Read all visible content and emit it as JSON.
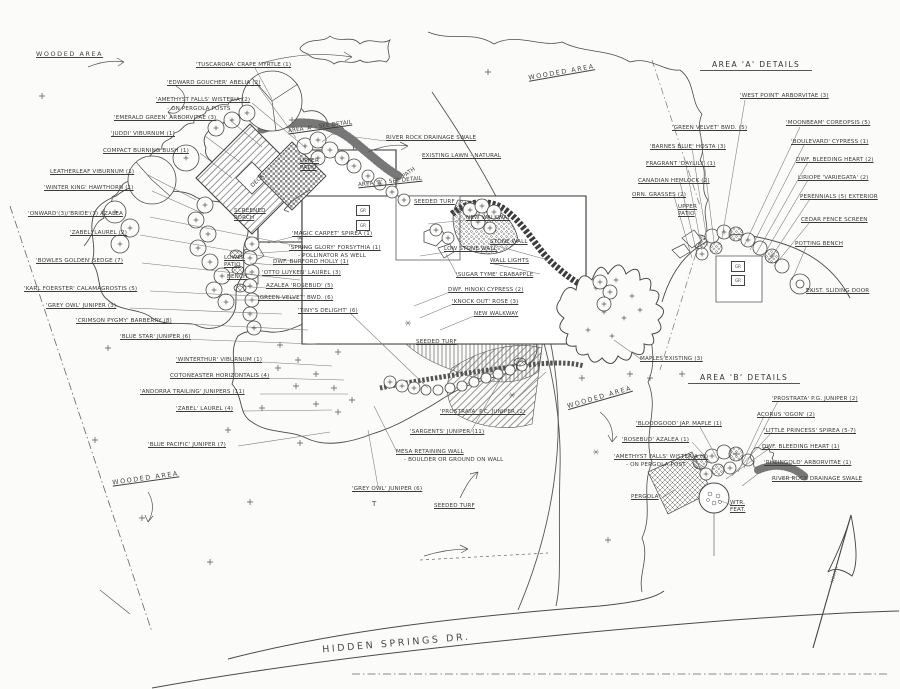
{
  "titles": {
    "area_a": "AREA 'A' DETAILS",
    "area_b": "AREA 'B' DETAILS",
    "road": "HIDDEN SPRINGS DR.",
    "north": "NORTH"
  },
  "misc": {
    "gr": "GR"
  },
  "main": {
    "labels": [
      "WOODED AREA",
      "'TUSCARORA' CRAPE MYRTLE (1)",
      "'EDWARD GOUCHER' ABELIA (2)",
      "'AMETHYST FALLS' WISTERIA (2)",
      "- ON PERGOLA POSTS",
      "'EMERALD GREEN' ARBORVITAE (3)",
      "'JUDDI' VIBURNUM (1)",
      "COMPACT BURNING BUSH (1)",
      "LEATHERLEAF VIBURNUM (1)",
      "'WINTER KING' HAWTHORN (1)",
      "'ONWARD'(3)/'BRIDE'(3) AZALEA",
      "'ZABEL' LAUREL (2)",
      "'BOWLES GOLDEN' SEDGE (7)",
      "'KARL FOERSTER' CALAMAGROSTIS (5)",
      "'GREY OWL' JUNIPER (3)",
      "'CRIMSON PYGMY' BARBERRY (8)",
      "'BLUE STAR' JUNIPER (6)",
      "'WINTERTHUR' VIBURNUM (1)",
      "COTONEASTER HORIZONTALIS (4)",
      "'ANDORRA TRAILING' JUNIPERS (11)",
      "'ZABEL' LAUREL (4)",
      "'BLUE PACIFIC' JUNIPER (7)",
      "WOODED AREA",
      "SCREENED PORCH",
      "'MAGIC CARPET' SPIREA (1)",
      "'SPRING GLORY' FORSYTHIA (1)",
      "- POLLINATOR AS WELL",
      "DWF. BURFORD HOLLY (1)",
      "'OTTO LUYKEN' LAUREL (3)",
      "AZALEA 'ROSEBUD' (5)",
      "'GREEN VELVET' BWD. (6)",
      "'TINY'S DELIGHT' (6)",
      "AREA 'A' - SEE DETAIL",
      "RIVER ROCK DRAINAGE SWALE",
      "EXISTING LAWN - NATURAL",
      "UPPER PATIO",
      "AREA 'B' - SEE DETAIL",
      "PATH",
      "SEEDED TURF",
      "NEW WALKWAY",
      "STONE WALL",
      "LOW STONE WALL",
      "WALL LIGHTS",
      "'SUGAR TYME' CRABAPPLE",
      "DWF. HINOKI CYPRESS (2)",
      "'KNOCK OUT' ROSE (3)",
      "NEW WALKWAY",
      "SEEDED TURF",
      "'PROSTRATA' P.C. JUNIPER (2)",
      "'SARGENTS' JUNIPER (11)",
      "MESA RETAINING WALL",
      "- BOULDER OR GROUND ON WALL",
      "'GREY OWL' JUNIPER (6)",
      "SEEDED TURF",
      "MAPLES EXISTING (3)",
      "WOODED AREA",
      "WOODED AREA",
      "DECK",
      "T",
      "LOWER PATIO",
      "BENCH"
    ]
  },
  "area_a": {
    "labels": [
      "'WEST POINT' ARBORVITAE (3)",
      "'GREEN VELVET' BWD. (5)",
      "'BARNES BLUE' HOSTA (3)",
      "FRAGRANT 'DAYLILY' (1)",
      "CANADIAN HEMLOCK (2)",
      "ORN. GRASSES (2)",
      "UPPER PATIO",
      "'MOONBEAM' COREOPSIS (5)",
      "'BOULEVARD' CYPRESS (1)",
      "DWF. BLEEDING HEART (2)",
      "LIRIOPE 'VARIEGATA' (2)",
      "PERENNIALS (5) EXTERIOR",
      "CEDAR FENCE SCREEN",
      "POTTING BENCH",
      "EXIST. SLIDING DOOR"
    ]
  },
  "area_b": {
    "labels": [
      "'BLOODGOOD' JAP. MAPLE (1)",
      "'ROSEBUD' AZALEA (1)",
      "'AMETHYST FALLS' WISTERIA (1)",
      "- ON PERGOLA POST",
      "PERGOLA",
      "'PROSTRATA' P.G. JUNIPER (2)",
      "ACORUS 'OGON' (2)",
      "'LITTLE PRINCESS' SPIREA (5-7)",
      "DWF. BLEEDING HEART (1)",
      "'RHEINGOLD' ARBORVITAE (1)",
      "RIVER ROCK DRAINAGE SWALE",
      "WTR. FEAT."
    ]
  }
}
